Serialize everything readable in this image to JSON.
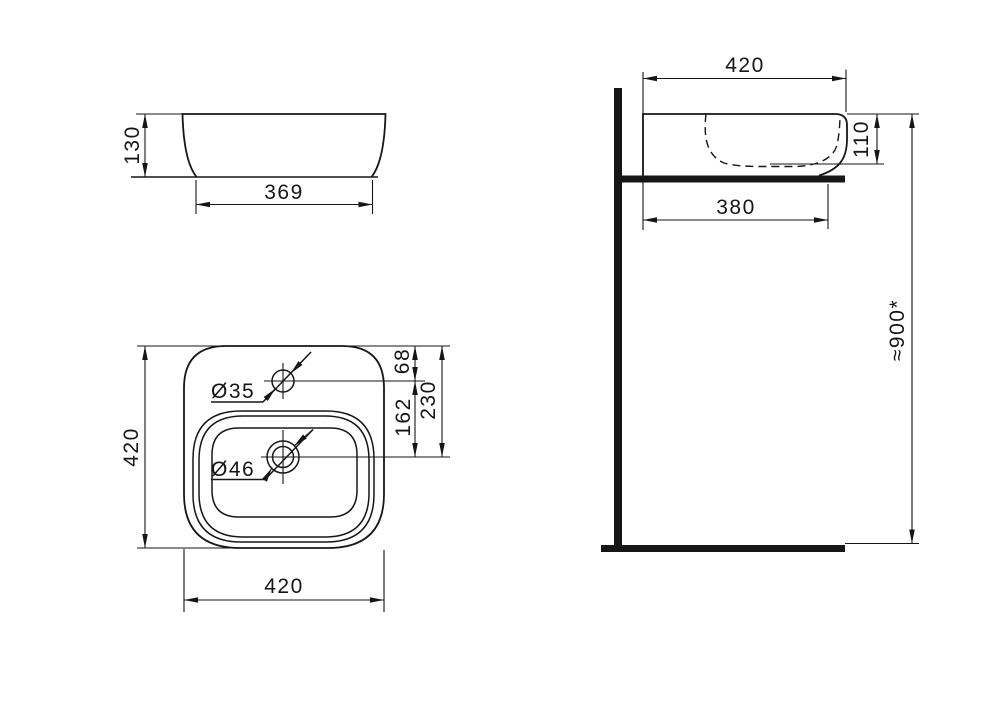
{
  "views": {
    "side": {
      "height": "130",
      "base_width": "369"
    },
    "section": {
      "rim_width": "420",
      "bowl_depth": "110",
      "base_width": "380",
      "mounting_height": "≈900*"
    },
    "plan": {
      "overall_depth": "420",
      "overall_width": "420",
      "tap_hole_diameter": "Ø35",
      "drain_diameter": "Ø46",
      "tap_hole_offset_from_back": "68",
      "tap_hole_to_drain": "162",
      "drain_offset_from_back": "230"
    }
  },
  "colors": {
    "line": "#161616",
    "background": "#ffffff"
  }
}
